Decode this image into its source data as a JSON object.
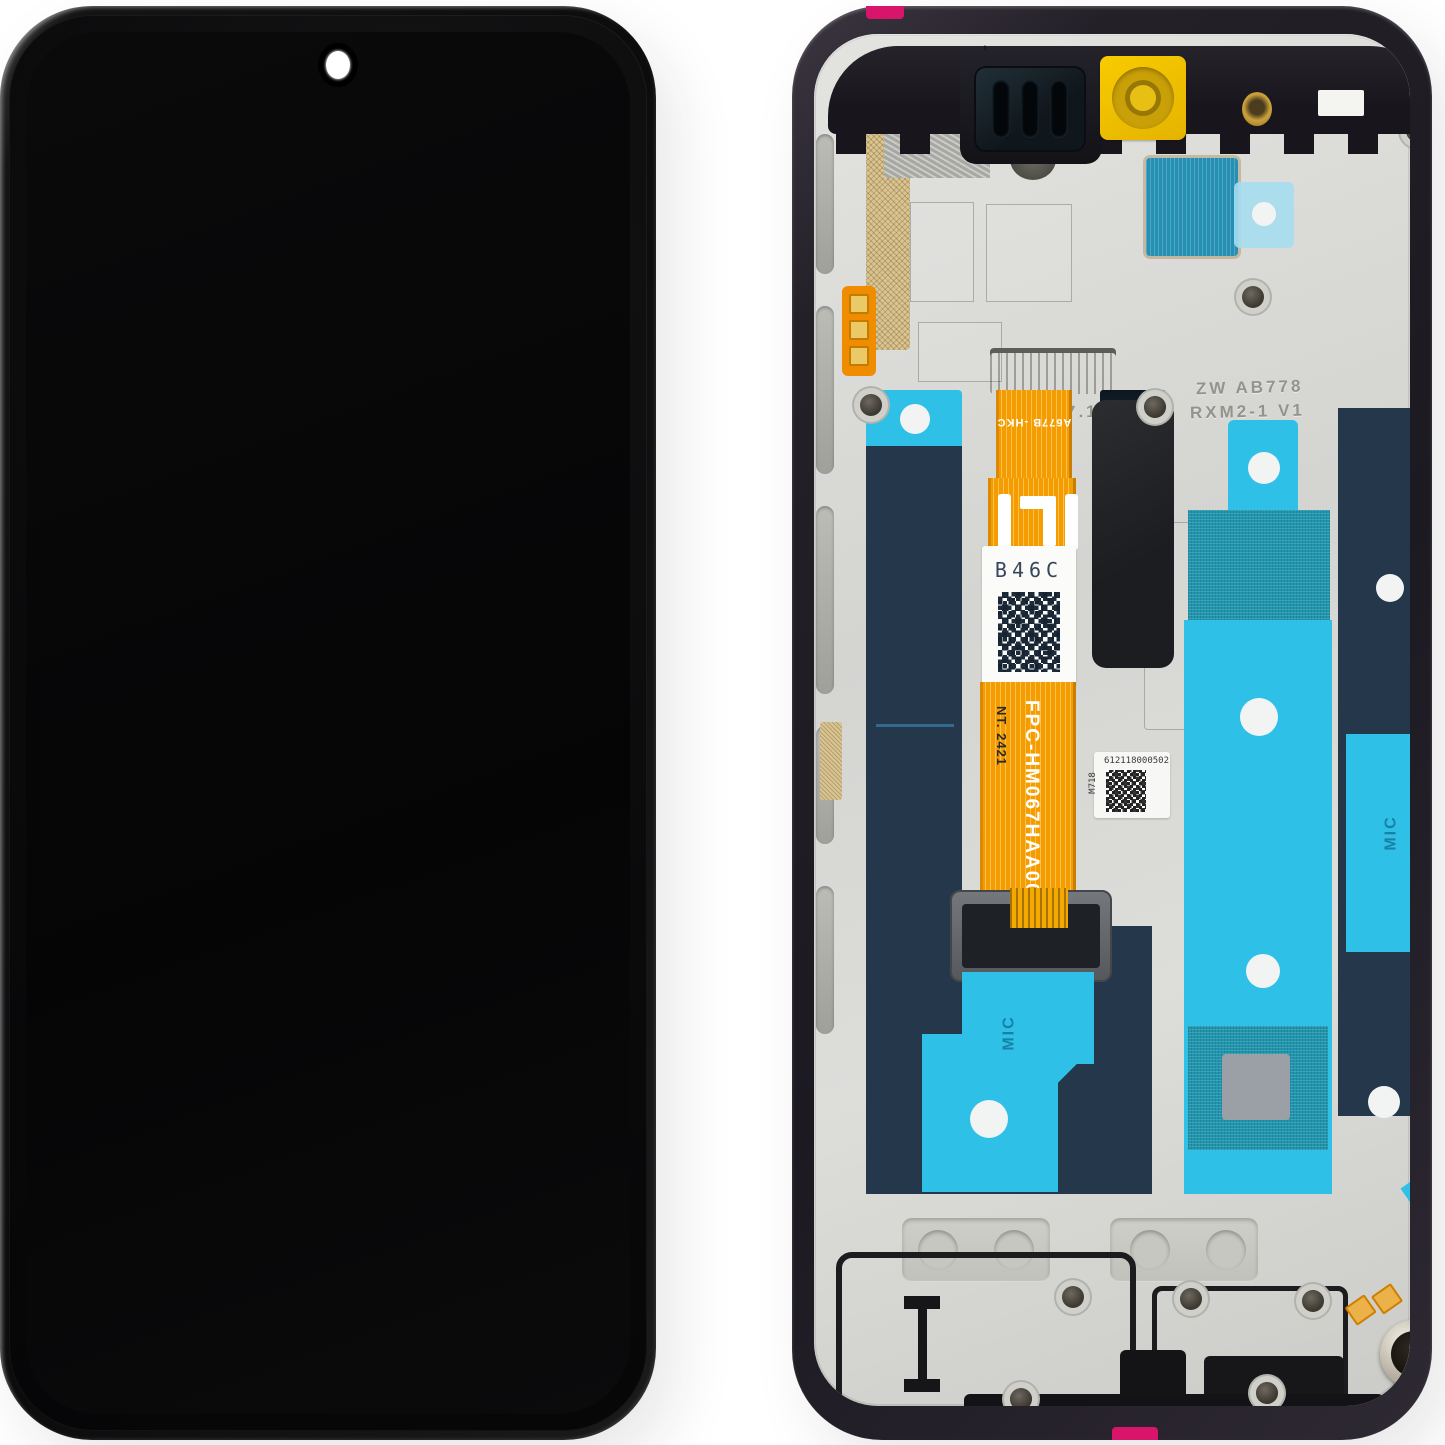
{
  "palette": {
    "background": "#ffffff",
    "frame_dark": "#232027",
    "metal_plate": "#d7d7d4",
    "adhesive_cyan": "#2fc0e8",
    "adhesive_teal_mesh": "#1f95ae",
    "adhesive_navy": "#25374b",
    "flex_orange": "#f49c00",
    "kapton_yellow": "#eec200",
    "tab_pink": "#d9156b",
    "label_white": "#f7f7f5"
  },
  "rear_assembly": {
    "flex_markings": {
      "connector_code": "A677B -HKC",
      "fpc_code": "FPC-HM067HAA00-A",
      "nt_code": "NT. 2421"
    },
    "labels": {
      "qr_label_code": "B46C",
      "serial_label_number": "612118000502",
      "serial_label_side": "M718"
    },
    "stamps": {
      "stamp_left": "7.1-S",
      "stamp_right_line1": "ZW AB778",
      "stamp_right_line2": "RXM2-1 V1"
    },
    "adhesive_markings": {
      "mic_left": "MIC",
      "mic_right": "MIC"
    },
    "glyphs": {
      "arrow_down": "↓"
    }
  }
}
